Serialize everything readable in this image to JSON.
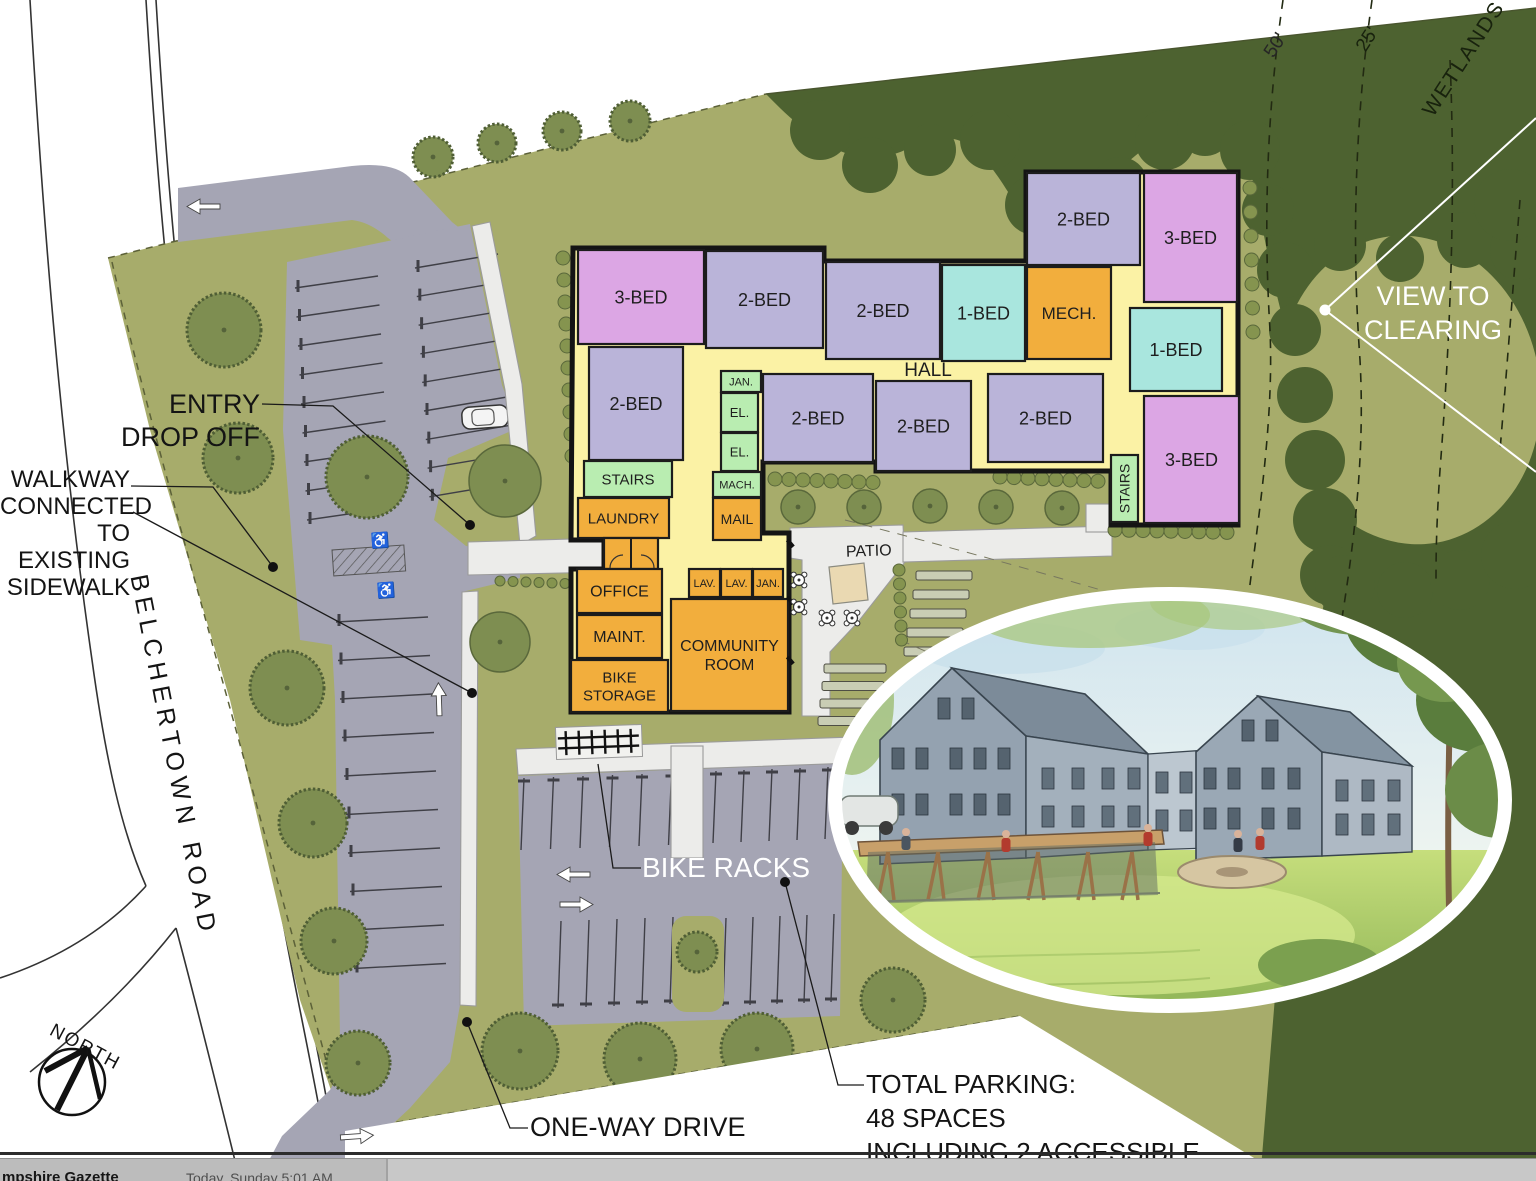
{
  "plan": {
    "hall": "HALL",
    "patio": "PATIO",
    "rooms": [
      {
        "label": "3-BED",
        "type": "bed3",
        "x": 578,
        "y": 250,
        "w": 126,
        "h": 94
      },
      {
        "label": "2-BED",
        "type": "bed2",
        "x": 706,
        "y": 251,
        "w": 117,
        "h": 97
      },
      {
        "label": "2-BED",
        "type": "bed2",
        "x": 826,
        "y": 262,
        "w": 114,
        "h": 97
      },
      {
        "label": "1-BED",
        "type": "bed1",
        "x": 942,
        "y": 265,
        "w": 83,
        "h": 96
      },
      {
        "label": "MECH.",
        "type": "service",
        "x": 1027,
        "y": 267,
        "w": 84,
        "h": 92,
        "fs": 17
      },
      {
        "label": "2-BED",
        "type": "bed2",
        "x": 1027,
        "y": 173,
        "w": 113,
        "h": 92
      },
      {
        "label": "3-BED",
        "type": "bed3",
        "x": 1144,
        "y": 173,
        "w": 93,
        "h": 129
      },
      {
        "label": "1-BED",
        "type": "bed1",
        "x": 1130,
        "y": 308,
        "w": 92,
        "h": 83
      },
      {
        "label": "3-BED",
        "type": "bed3",
        "x": 1144,
        "y": 396,
        "w": 95,
        "h": 127
      },
      {
        "label": "2-BED",
        "type": "bed2",
        "x": 589,
        "y": 347,
        "w": 94,
        "h": 113
      },
      {
        "label": "STAIRS",
        "type": "stairs",
        "x": 584,
        "y": 461,
        "w": 88,
        "h": 36,
        "fs": 15
      },
      {
        "label": "LAUNDRY",
        "type": "service",
        "x": 578,
        "y": 498,
        "w": 91,
        "h": 40,
        "fs": 15
      },
      {
        "label": "JAN.",
        "type": "stairs",
        "x": 721,
        "y": 371,
        "w": 40,
        "h": 21,
        "fs": 11
      },
      {
        "label": "EL.",
        "type": "stairs",
        "x": 721,
        "y": 393,
        "w": 37,
        "h": 39,
        "fs": 13
      },
      {
        "label": "EL.",
        "type": "stairs",
        "x": 721,
        "y": 433,
        "w": 37,
        "h": 38,
        "fs": 13
      },
      {
        "label": "MACH.",
        "type": "stairs",
        "x": 713,
        "y": 472,
        "w": 48,
        "h": 25,
        "fs": 11
      },
      {
        "label": "MAIL",
        "type": "service",
        "x": 713,
        "y": 498,
        "w": 48,
        "h": 42,
        "fs": 14
      },
      {
        "label": "2-BED",
        "type": "bed2",
        "x": 763,
        "y": 374,
        "w": 110,
        "h": 88
      },
      {
        "label": "2-BED",
        "type": "bed2",
        "x": 876,
        "y": 381,
        "w": 95,
        "h": 90
      },
      {
        "label": "2-BED",
        "type": "bed2",
        "x": 988,
        "y": 374,
        "w": 115,
        "h": 88
      },
      {
        "label": "STAIRS",
        "type": "stairs",
        "x": 1111,
        "y": 455,
        "w": 27,
        "h": 67,
        "fs": 14,
        "vert": true
      },
      {
        "label": "",
        "type": "service",
        "x": 604,
        "y": 538,
        "w": 54,
        "h": 31
      },
      {
        "label": "OFFICE",
        "type": "service",
        "x": 577,
        "y": 569,
        "w": 85,
        "h": 44,
        "fs": 16
      },
      {
        "label": "MAINT.",
        "type": "service",
        "x": 577,
        "y": 615,
        "w": 85,
        "h": 43,
        "fs": 16
      },
      {
        "label": "BIKE\nSTORAGE",
        "type": "service",
        "x": 571,
        "y": 660,
        "w": 97,
        "h": 52,
        "fs": 15
      },
      {
        "label": "LAV.",
        "type": "service",
        "x": 689,
        "y": 569,
        "w": 31,
        "h": 28,
        "fs": 11
      },
      {
        "label": "LAV.",
        "type": "service",
        "x": 721,
        "y": 569,
        "w": 31,
        "h": 28,
        "fs": 11
      },
      {
        "label": "JAN.",
        "type": "service",
        "x": 753,
        "y": 569,
        "w": 30,
        "h": 28,
        "fs": 11
      },
      {
        "label": "COMMUNITY\nROOM",
        "type": "service",
        "x": 671,
        "y": 599,
        "w": 117,
        "h": 112,
        "fs": 16
      }
    ]
  },
  "labels": {
    "entry": "ENTRY\nDROP OFF",
    "walkway": "WALKWAY\nCONNECTED\nTO EXISTING\nSIDEWALK",
    "road": "BELCHERTOWN ROAD",
    "north": "NORTH",
    "one_way": "ONE-WAY DRIVE",
    "bike_racks": "BIKE RACKS",
    "view": "VIEW TO\nCLEARING",
    "wetlands": "WETLANDS",
    "d50": "50'",
    "d25": "25'",
    "parking": "TOTAL PARKING:\n48 SPACES\nINCLUDING 2 ACCESSIBLE"
  },
  "statusbar": {
    "source": "mpshire Gazette",
    "datetime": "Today, Sunday 5:01 AM"
  },
  "colors": {
    "site_green": "#a7ac6b",
    "forest": "#4d6230",
    "pavement": "#a5a5b4",
    "walkway": "#ececea",
    "hall_yellow": "#fbf2a5",
    "room_1bed": "#a9e6de",
    "room_2bed": "#bab4d9",
    "room_3bed": "#dca6e4",
    "room_service": "#f2ae3d",
    "room_stairs": "#b9edb1",
    "patio_tan": "#ead9b2"
  }
}
